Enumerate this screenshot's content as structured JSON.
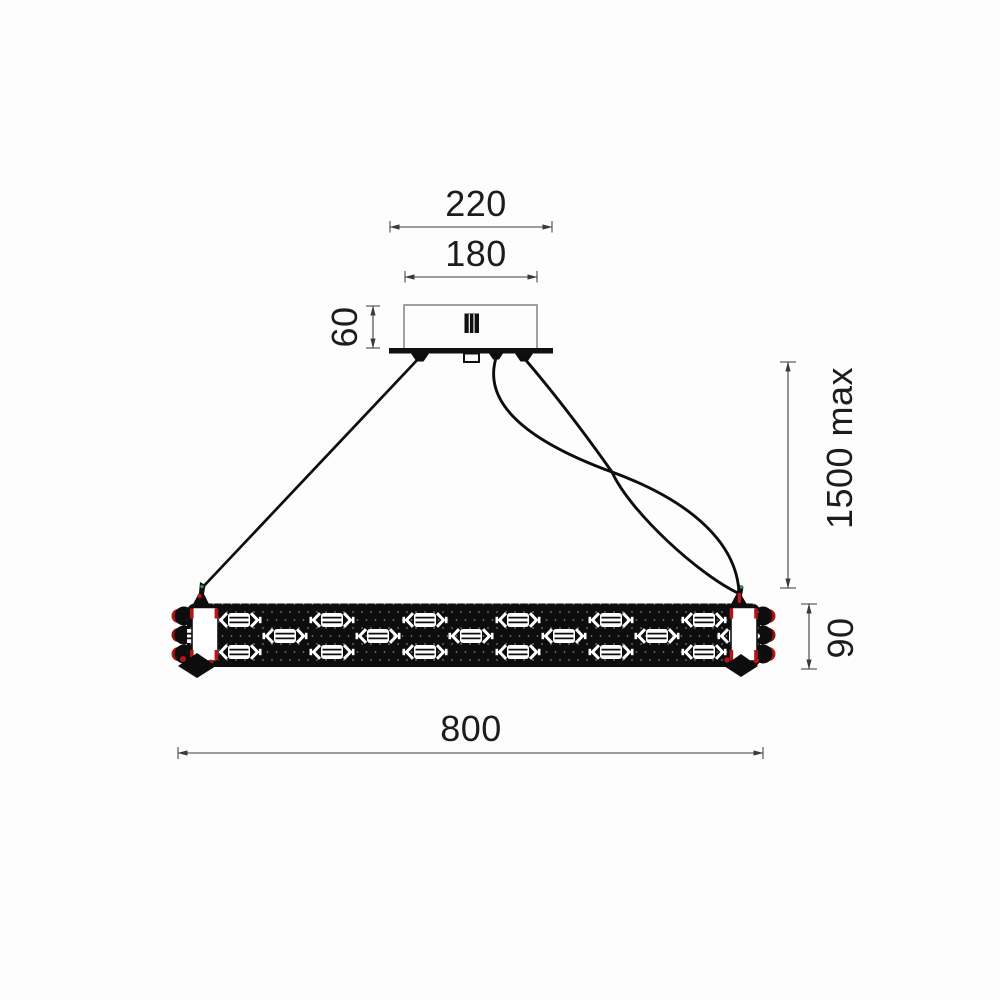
{
  "drawing": {
    "title": "suspended-linear-chandelier-dimension-drawing",
    "labels": {
      "canopy_plate_width": "220",
      "canopy_body_width": "180",
      "canopy_height": "60",
      "suspension_length_max": "1500 max",
      "fixture_body_height": "90",
      "fixture_length": "800"
    },
    "colors": {
      "background": "#fdfdfd",
      "line_ink": "#1c1c1c",
      "dimension_line": "#3a3a3a",
      "fixture_black": "#0d0d0d",
      "crystal_white": "#ffffff",
      "accent_red": "#b81414",
      "accent_green": "#2f8f3a",
      "canopy_outline_gray": "#8a8a8a"
    },
    "fixture": {
      "crystal_rows": {
        "top_y": 620,
        "middle_y": 636,
        "bottom_y": 652,
        "top_x": [
          239,
          332,
          425,
          518,
          611,
          704
        ],
        "middle_x": [
          192,
          285,
          378,
          471,
          564,
          657,
          740
        ],
        "bottom_x": [
          239,
          332,
          425,
          518,
          611,
          704
        ]
      }
    }
  }
}
